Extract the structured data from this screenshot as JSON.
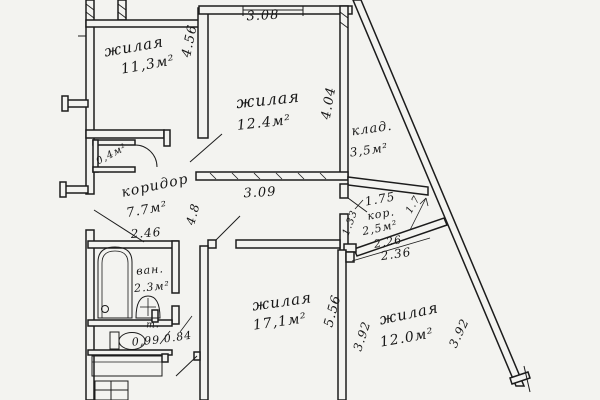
{
  "document": {
    "type": "apartment floor plan",
    "style": "scanned hand-drawn"
  },
  "colors": {
    "paper": "#f3f3f0",
    "ink": "#1c1c1c"
  },
  "rooms": {
    "living1": {
      "name": "жилая",
      "area": "11,3м²"
    },
    "living2": {
      "name": "жилая",
      "area": "12.4м²"
    },
    "storage": {
      "name": "клад.",
      "area": "3,5м²"
    },
    "corridor": {
      "name": "коридор",
      "area": "7.7м²"
    },
    "closet": {
      "area": "0,4м²"
    },
    "bath": {
      "name": "ван.",
      "area": "2.3м²"
    },
    "toilet": {
      "name": "т."
    },
    "hall": {
      "name": "кор.",
      "area": "2,5м²"
    },
    "living3": {
      "name": "жилая",
      "area": "17,1м²"
    },
    "living4": {
      "name": "жилая",
      "area": "12.0м²"
    }
  },
  "dims": {
    "top_width": "3.08",
    "living1_h": "4.56",
    "living2_h": "4.04",
    "living2_w": "3.09",
    "corridor_h": "4.8",
    "corridor_w": "2.46",
    "hall_top": "1.75",
    "hall_diag": "1.7",
    "hall_left": "1.33",
    "hall_w1": "2,26",
    "hall_w2": "2.36",
    "living3_h": "5.56",
    "living4_w": "3.92",
    "living4_w2": "3.92",
    "toilet_w": "0,99",
    "toilet_d": "0.84"
  }
}
